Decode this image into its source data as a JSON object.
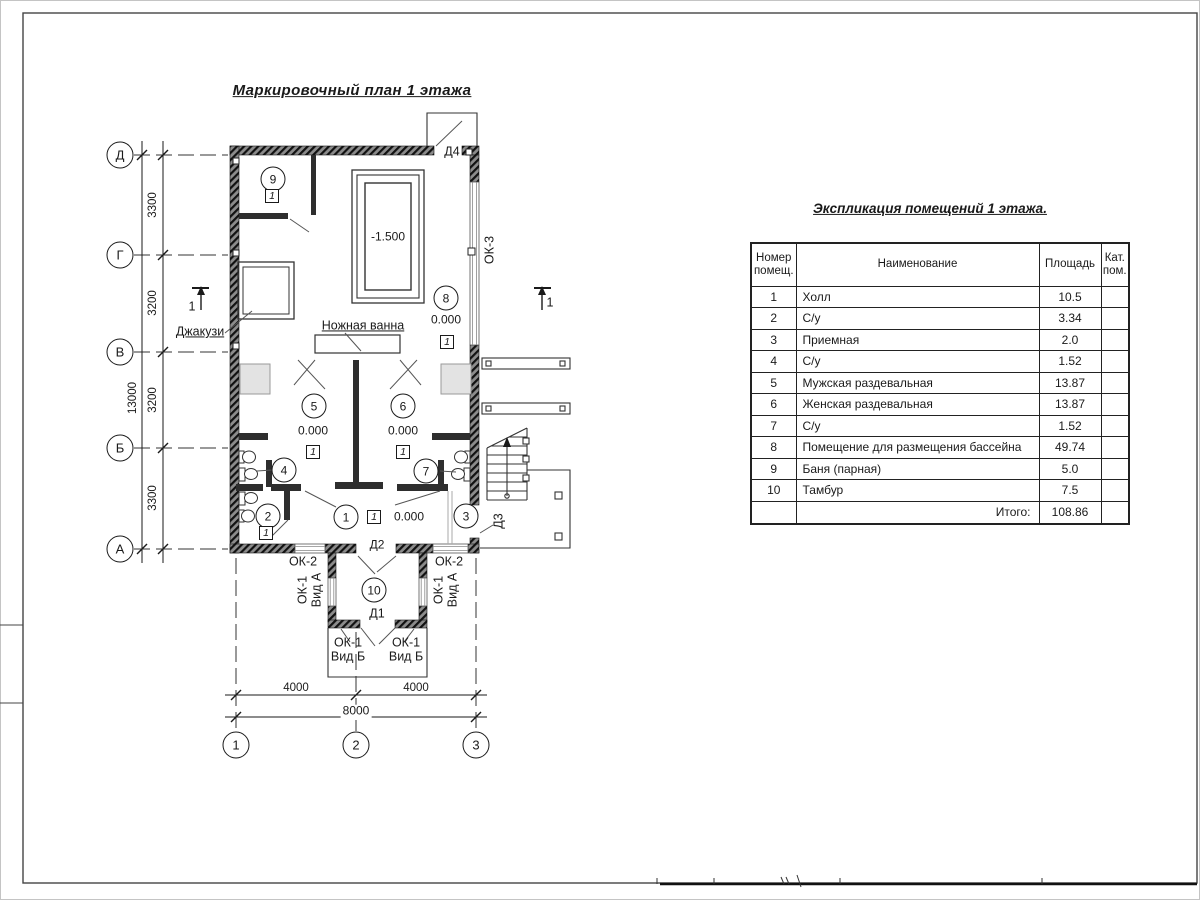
{
  "colors": {
    "ink": "#1a1a1a",
    "line": "#333333",
    "wall_dark": "#2e2e2e",
    "frame": "#444444",
    "light_fill": "#e3e3e3"
  },
  "drawing": {
    "plan_title": "Маркировочный план 1 этажа",
    "table_title": "Экспликация помещений 1 этажа."
  },
  "axes": {
    "rows": [
      "Д",
      "Г",
      "В",
      "Б",
      "А"
    ],
    "cols": [
      "1",
      "2",
      "3"
    ]
  },
  "dims": {
    "v_chain": [
      "3300",
      "3200",
      "3200",
      "3300"
    ],
    "v_total": "13000",
    "h_chain": [
      "4000",
      "4000"
    ],
    "h_total": "8000"
  },
  "rooms": [
    "1",
    "2",
    "3",
    "4",
    "5",
    "6",
    "7",
    "8",
    "9",
    "10"
  ],
  "marks": {
    "floor_marker": "1",
    "section": "1",
    "elev_zero": "0.000",
    "elev_pool": "-1.500"
  },
  "labels": {
    "jacuzzi": "Джакузи",
    "foot_bath": "Ножная ванна",
    "d1": "Д1",
    "d2": "Д2",
    "d3": "Д3",
    "d4": "Д4",
    "ok1": "ОК-1",
    "ok2": "ОК-2",
    "ok3": "ОК-3",
    "vid_a": "Вид А",
    "vid_b": "Вид Б"
  },
  "table": {
    "headers": {
      "num": "Номер помещ.",
      "name": "Наименование",
      "area": "Площадь",
      "cat": "Кат. пом."
    },
    "rows": [
      {
        "num": "1",
        "name": "Холл",
        "area": "10.5"
      },
      {
        "num": "2",
        "name": "С/у",
        "area": "3.34"
      },
      {
        "num": "3",
        "name": "Приемная",
        "area": "2.0"
      },
      {
        "num": "4",
        "name": "С/у",
        "area": "1.52"
      },
      {
        "num": "5",
        "name": "Мужская раздевальная",
        "area": "13.87"
      },
      {
        "num": "6",
        "name": "Женская раздевальная",
        "area": "13.87"
      },
      {
        "num": "7",
        "name": "С/у",
        "area": "1.52"
      },
      {
        "num": "8",
        "name": "Помещение для размещения бассейна",
        "area": "49.74"
      },
      {
        "num": "9",
        "name": "Баня (парная)",
        "area": "5.0"
      },
      {
        "num": "10",
        "name": "Тамбур",
        "area": "7.5"
      }
    ],
    "total_label": "Итого:",
    "total_value": "108.86"
  }
}
